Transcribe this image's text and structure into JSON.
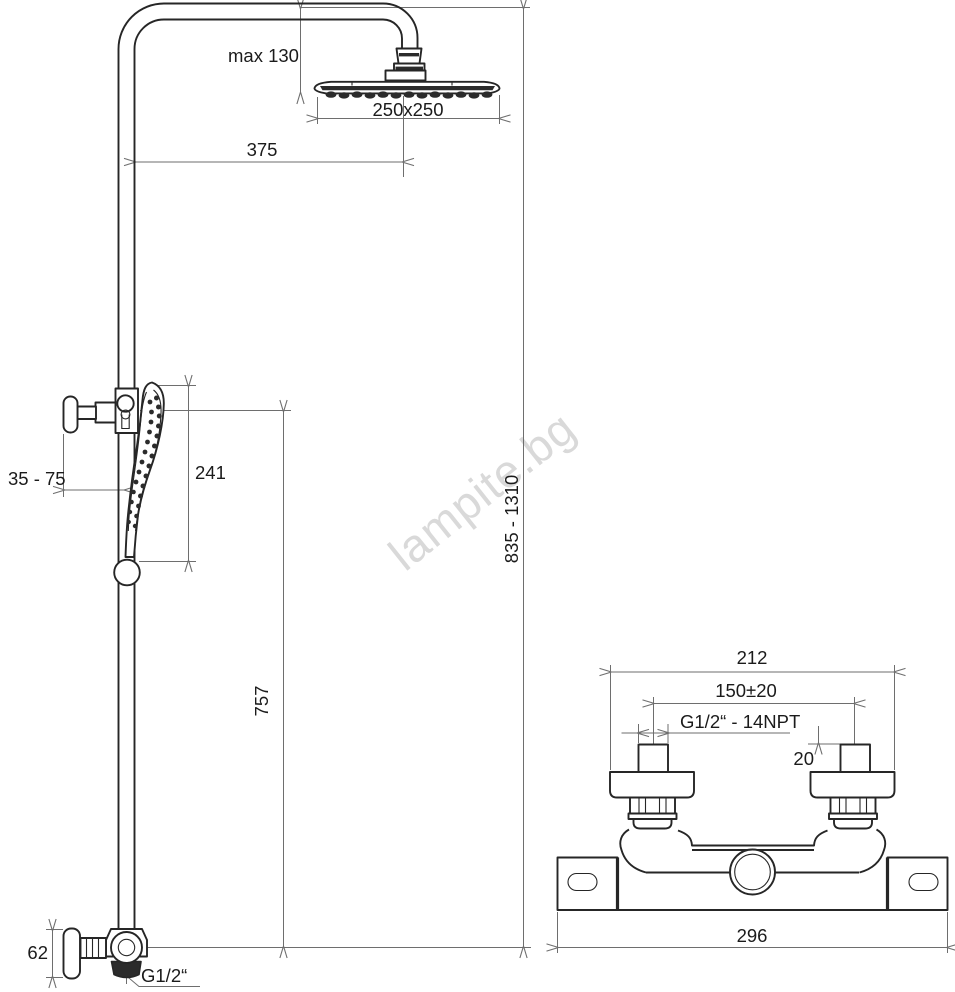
{
  "watermark": {
    "text": "lampite.bg"
  },
  "shower_column": {
    "labels": {
      "max_head_offset": "max 130",
      "head_dimensions": "250x250",
      "arm_projection": "375",
      "holder_wall_distance": "35 - 75",
      "hand_shower_length": "241",
      "column_height_range": "835 - 1310",
      "riser_height": "757",
      "supply_elbow_height": "62",
      "supply_thread": "G1/2“"
    }
  },
  "mixer": {
    "labels": {
      "overall_width": "212",
      "inlet_spacing": "150±20",
      "inlet_thread": "G1/2“ - 14NPT",
      "thread_length": "20",
      "body_width": "296"
    }
  }
}
